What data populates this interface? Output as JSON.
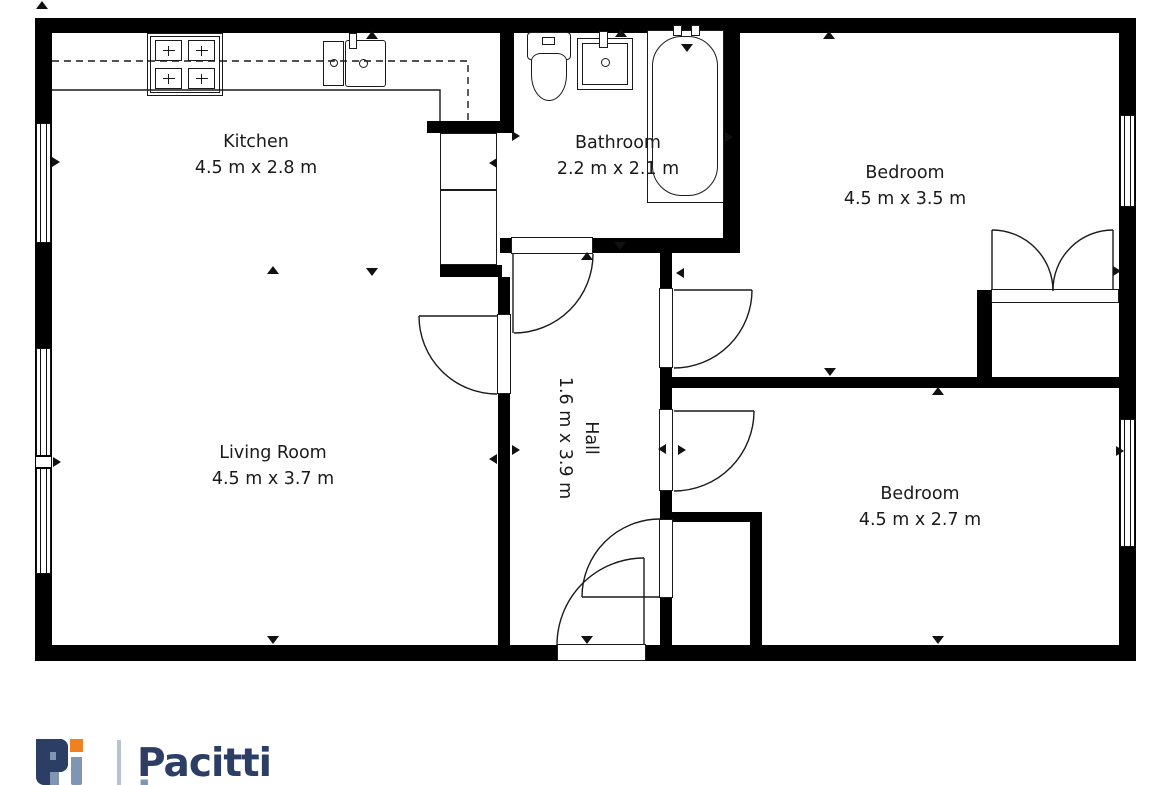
{
  "plan": {
    "rooms": [
      {
        "id": "kitchen",
        "name": "Kitchen",
        "dims": "4.5 m x 2.8 m",
        "cx": 256,
        "cy": 155,
        "rotate": 0
      },
      {
        "id": "bathroom",
        "name": "Bathroom",
        "dims": "2.2 m x 2.1 m",
        "cx": 618,
        "cy": 156,
        "rotate": 0
      },
      {
        "id": "bedroom-1",
        "name": "Bedroom",
        "dims": "4.5 m x 3.5 m",
        "cx": 905,
        "cy": 186,
        "rotate": 0
      },
      {
        "id": "living-room",
        "name": "Living Room",
        "dims": "4.5 m x 3.7 m",
        "cx": 273,
        "cy": 466,
        "rotate": 0
      },
      {
        "id": "hall",
        "name": "Hall",
        "dims": "1.6 m x 3.9 m",
        "cx": 578,
        "cy": 438,
        "rotate": 90
      },
      {
        "id": "bedroom-2",
        "name": "Bedroom",
        "dims": "4.5 m x 2.7 m",
        "cx": 920,
        "cy": 507,
        "rotate": 0
      }
    ],
    "markers": [
      {
        "x": 42,
        "y": 1,
        "dir": "up"
      },
      {
        "x": 372,
        "y": 31,
        "dir": "up"
      },
      {
        "x": 621,
        "y": 29,
        "dir": "up"
      },
      {
        "x": 829,
        "y": 31,
        "dir": "up"
      },
      {
        "x": 60,
        "y": 162,
        "dir": "right"
      },
      {
        "x": 489,
        "y": 163,
        "dir": "left"
      },
      {
        "x": 520,
        "y": 136,
        "dir": "right"
      },
      {
        "x": 733,
        "y": 137,
        "dir": "right"
      },
      {
        "x": 620,
        "y": 250,
        "dir": "down"
      },
      {
        "x": 587,
        "y": 252,
        "dir": "up"
      },
      {
        "x": 273,
        "y": 266,
        "dir": "up"
      },
      {
        "x": 372,
        "y": 276,
        "dir": "down"
      },
      {
        "x": 676,
        "y": 273,
        "dir": "left"
      },
      {
        "x": 61,
        "y": 462,
        "dir": "right"
      },
      {
        "x": 489,
        "y": 459,
        "dir": "left"
      },
      {
        "x": 520,
        "y": 450,
        "dir": "right"
      },
      {
        "x": 658,
        "y": 449,
        "dir": "left"
      },
      {
        "x": 686,
        "y": 450,
        "dir": "right"
      },
      {
        "x": 830,
        "y": 376,
        "dir": "down"
      },
      {
        "x": 938,
        "y": 387,
        "dir": "up"
      },
      {
        "x": 1121,
        "y": 271,
        "dir": "right"
      },
      {
        "x": 1124,
        "y": 451,
        "dir": "right"
      },
      {
        "x": 273,
        "y": 644,
        "dir": "down"
      },
      {
        "x": 587,
        "y": 644,
        "dir": "down"
      },
      {
        "x": 938,
        "y": 644,
        "dir": "down"
      }
    ]
  },
  "logo": {
    "word1": "Pacitti",
    "word2": "Jones"
  },
  "colors": {
    "wall": "#000000",
    "line": "#1a1a1a",
    "navy": "#2c3e63",
    "orange": "#f08123",
    "slate": "#7e96b4",
    "separator": "#b8c3d1"
  }
}
